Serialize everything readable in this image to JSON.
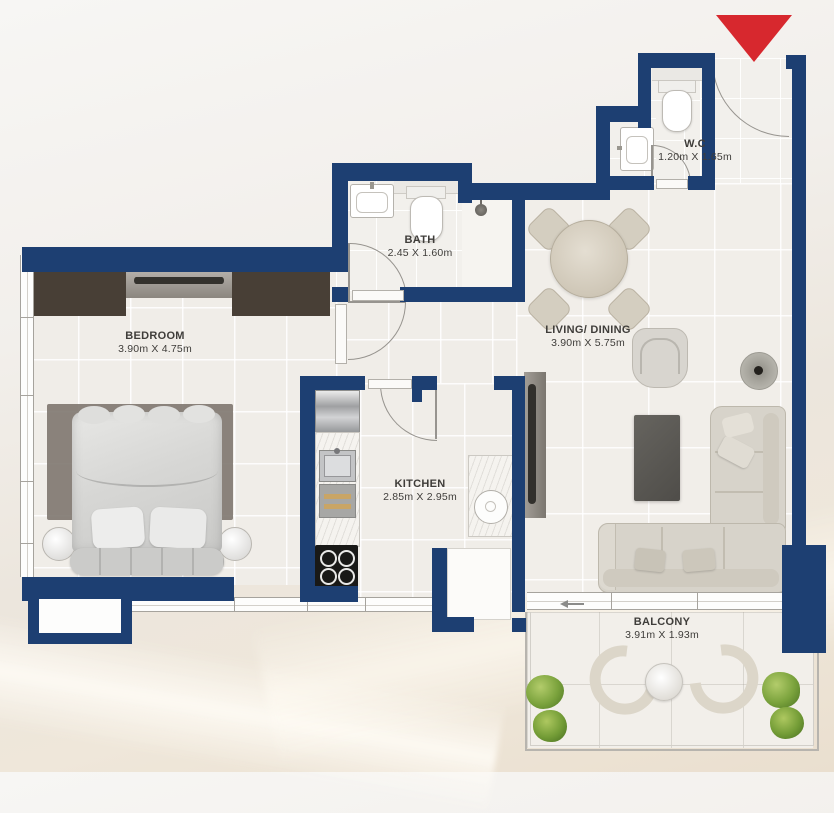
{
  "plan": {
    "colors": {
      "wall": "#1d3f72",
      "entry_marker": "#d7282e",
      "wardrobe": "#483f36"
    },
    "rooms": [
      {
        "id": "bedroom",
        "name": "BEDROOM",
        "dimensions": "3.90m X 4.75m"
      },
      {
        "id": "bath",
        "name": "BATH",
        "dimensions": "2.45 X 1.60m"
      },
      {
        "id": "wc",
        "name": "W.C",
        "dimensions": "1.20m X 1.65m"
      },
      {
        "id": "living_dining",
        "name": "LIVING/ DINING",
        "dimensions": "3.90m X 5.75m"
      },
      {
        "id": "kitchen",
        "name": "KITCHEN",
        "dimensions": "2.85m X 2.95m"
      },
      {
        "id": "balcony",
        "name": "BALCONY",
        "dimensions": "3.91m X 1.93m"
      }
    ]
  }
}
